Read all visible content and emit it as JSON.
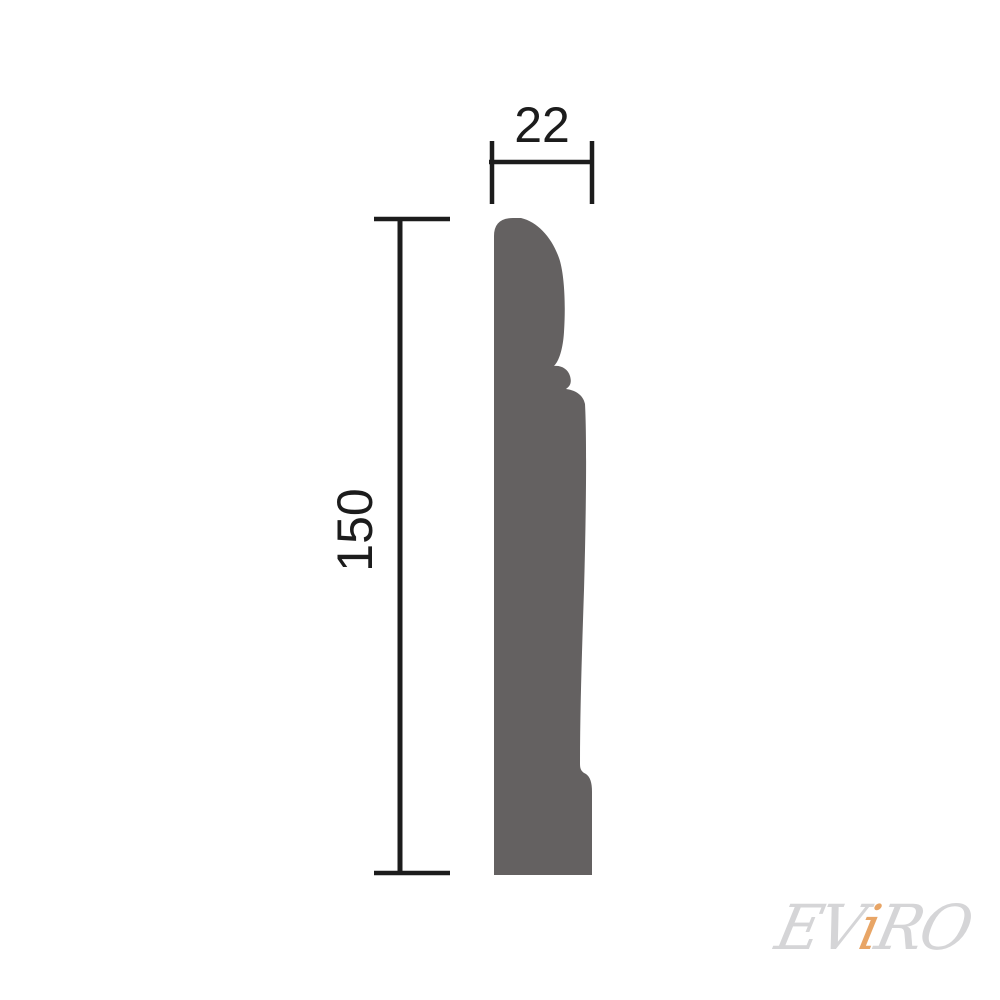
{
  "dimensions": {
    "width": {
      "label": "22"
    },
    "height": {
      "label": "150"
    }
  },
  "profile": {
    "fill": "#646161"
  },
  "lines": {
    "color": "#1c1c1c"
  },
  "watermark": {
    "ev": "EV",
    "i": "i",
    "ro": "RO",
    "gray_color": "#d5d5d7",
    "accent_color": "#e8a566"
  }
}
